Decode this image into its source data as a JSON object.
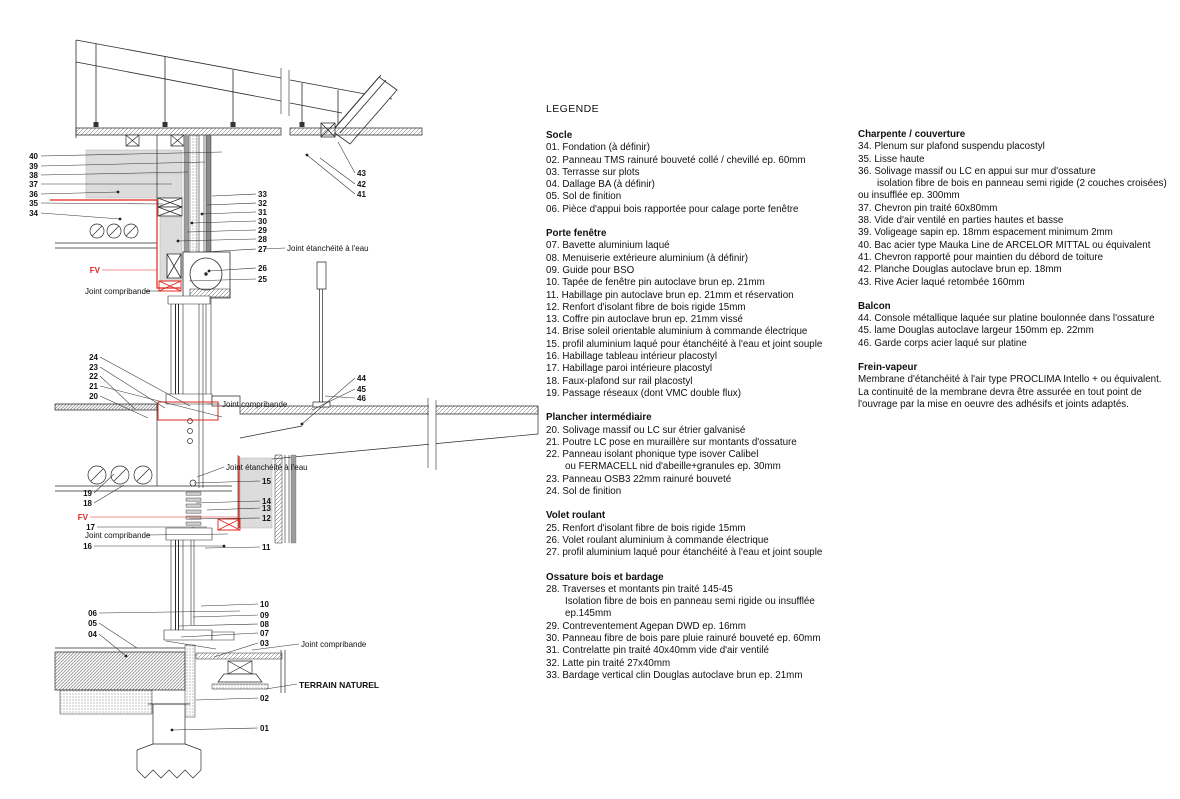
{
  "legend": {
    "title": "LEGENDE",
    "col1": [
      {
        "h": "Socle",
        "items": [
          {
            "n": "01.",
            "t": "Fondation (à définir)"
          },
          {
            "n": "02.",
            "t": "Panneau TMS rainuré bouveté collé / chevillé ep. 60mm"
          },
          {
            "n": "03.",
            "t": "Terrasse sur plots"
          },
          {
            "n": "04.",
            "t": "Dallage BA (à définir)"
          },
          {
            "n": "05.",
            "t": "Sol de finition"
          },
          {
            "n": "06.",
            "t": "Pièce d'appui bois rapportée pour calage porte fenêtre"
          }
        ]
      },
      {
        "h": "Porte fenêtre",
        "items": [
          {
            "n": "07.",
            "t": "Bavette aluminium laqué"
          },
          {
            "n": "08.",
            "t": "Menuiserie extérieure aluminium (à définir)"
          },
          {
            "n": "09.",
            "t": "Guide pour BSO"
          },
          {
            "n": "10.",
            "t": "Tapée de fenêtre pin autoclave brun ep. 21mm"
          },
          {
            "n": "11.",
            "t": "Habillage pin autoclave brun ep. 21mm et réservation"
          },
          {
            "n": "12.",
            "t": "Renfort d'isolant fibre de bois rigide 15mm"
          },
          {
            "n": "13.",
            "t": "Coffre pin autoclave brun ep. 21mm vissé"
          },
          {
            "n": "14.",
            "t": "Brise soleil orientable aluminium à commande électrique"
          },
          {
            "n": "15.",
            "t": "profil aluminium laqué pour étanchéité à l'eau et joint souple"
          },
          {
            "n": "16.",
            "t": "Habillage tableau intérieur placostyl"
          },
          {
            "n": "17.",
            "t": "Habillage paroi intérieure placostyl"
          },
          {
            "n": "18.",
            "t": "Faux-plafond sur rail placostyl"
          },
          {
            "n": "19.",
            "t": "Passage réseaux (dont VMC double flux)"
          }
        ]
      },
      {
        "h": "Plancher intermédiaire",
        "items": [
          {
            "n": "20.",
            "t": "Solivage massif ou LC sur étrier galvanisé"
          },
          {
            "n": "21.",
            "t": "Poutre LC pose en muraillère sur montants d'ossature"
          },
          {
            "n": "22.",
            "t": "Panneau isolant phonique type isover Calibel",
            "sub": [
              {
                "t": "ou FERMACELL nid d'abeille+granules ep. 30mm",
                "i": 1
              }
            ]
          },
          {
            "n": "23.",
            "t": "Panneau OSB3 22mm rainuré bouveté"
          },
          {
            "n": "24.",
            "t": "Sol de finition"
          }
        ]
      },
      {
        "h": "Volet roulant",
        "items": [
          {
            "n": "25.",
            "t": "Renfort d'isolant fibre de bois rigide 15mm"
          },
          {
            "n": "26.",
            "t": "Volet roulant aluminium à commande électrique"
          },
          {
            "n": "27.",
            "t": "profil aluminium laqué pour étanchéité à l'eau et joint souple"
          }
        ]
      },
      {
        "h": "Ossature bois et bardage",
        "items": [
          {
            "n": "28.",
            "t": "Traverses et montants pin traité 145-45",
            "sub": [
              {
                "t": "Isolation fibre de bois en panneau semi rigide ou insufflée ep.145mm",
                "i": 1
              }
            ]
          },
          {
            "n": "29.",
            "t": "Contreventement Agepan DWD ep. 16mm"
          },
          {
            "n": "30.",
            "t": "Panneau fibre de bois pare pluie rainuré bouveté ep. 60mm"
          },
          {
            "n": "31.",
            "t": "Contrelatte pin traité 40x40mm vide d'air ventilé"
          },
          {
            "n": "32.",
            "t": "Latte pin traité 27x40mm"
          },
          {
            "n": "33.",
            "t": "Bardage vertical clin Douglas autoclave brun ep. 21mm"
          }
        ]
      }
    ],
    "col2": [
      {
        "h": "Charpente / couverture",
        "items": [
          {
            "n": "34.",
            "t": "Plenum sur plafond suspendu placostyl"
          },
          {
            "n": "35.",
            "t": "Lisse haute"
          },
          {
            "n": "36.",
            "t": "Solivage massif ou LC en appui sur mur d'ossature",
            "sub": [
              {
                "t": "isolation fibre de bois en panneau semi rigide (2 couches croisées)",
                "i": 1
              },
              {
                "t": "ou insufflée ep. 300mm",
                "i": 0
              }
            ]
          },
          {
            "n": "37.",
            "t": "Chevron pin traité 60x80mm"
          },
          {
            "n": "38.",
            "t": "Vide d'air ventilé en parties hautes et basse"
          },
          {
            "n": "39.",
            "t": "Voligeage sapin ep. 18mm espacement minimum 2mm"
          },
          {
            "n": "40.",
            "t": "Bac acier type Mauka Line de ARCELOR MITTAL ou équivalent"
          },
          {
            "n": "41.",
            "t": "Chevron rapporté pour maintien du débord de toiture"
          },
          {
            "n": "42.",
            "t": "Planche Douglas autoclave brun ep. 18mm"
          },
          {
            "n": "43.",
            "t": "Rive Acier laqué retombée 160mm"
          }
        ]
      },
      {
        "h": "Balcon",
        "items": [
          {
            "n": "44.",
            "t": "Console métallique laquée sur platine boulonnée dans l'ossature"
          },
          {
            "n": "45.",
            "t": "lame Douglas autoclave largeur 150mm ep. 22mm"
          },
          {
            "n": "46.",
            "t": "Garde corps acier laqué sur platine"
          }
        ]
      },
      {
        "h": "Frein-vapeur",
        "para": [
          "Membrane d'étanchéité à l'air type PROCLIMA Intello + ou équivalent.",
          "La continuité de la membrane devra être assurée en tout point de",
          "l'ouvrage par la mise en oeuvre des adhésifs et joints adaptés."
        ]
      }
    ]
  },
  "drawing": {
    "colors": {
      "membrane": "#e0261c",
      "insulation": "#dcdcdc",
      "panel": "#9c9c9c",
      "line": "#2a2a2a"
    },
    "callouts": [
      {
        "t": "40",
        "x": 38,
        "y": 159,
        "a": "e",
        "l": [
          41,
          156,
          222,
          152
        ]
      },
      {
        "t": "39",
        "x": 38,
        "y": 169,
        "a": "e",
        "l": [
          41,
          166,
          205,
          162
        ]
      },
      {
        "t": "38",
        "x": 38,
        "y": 178,
        "a": "e",
        "l": [
          41,
          175,
          188,
          172
        ]
      },
      {
        "t": "37",
        "x": 38,
        "y": 187,
        "a": "e",
        "l": [
          41,
          184,
          172,
          184
        ]
      },
      {
        "t": "36",
        "x": 38,
        "y": 197,
        "a": "e",
        "l": [
          41,
          194,
          118,
          192
        ],
        "d": 1
      },
      {
        "t": "35",
        "x": 38,
        "y": 206,
        "a": "e",
        "l": [
          41,
          203,
          163,
          204
        ]
      },
      {
        "t": "34",
        "x": 38,
        "y": 216,
        "a": "e",
        "l": [
          41,
          213,
          120,
          219
        ],
        "d": 1
      },
      {
        "t": "43",
        "x": 357,
        "y": 176,
        "a": "s",
        "l": [
          355,
          173,
          338,
          142
        ]
      },
      {
        "t": "42",
        "x": 357,
        "y": 187,
        "a": "s",
        "l": [
          355,
          184,
          320,
          158
        ]
      },
      {
        "t": "41",
        "x": 357,
        "y": 197,
        "a": "s",
        "l": [
          355,
          194,
          307,
          155
        ],
        "d": 1
      },
      {
        "t": "33",
        "x": 258,
        "y": 197,
        "a": "s",
        "l": [
          256,
          194,
          212,
          196
        ]
      },
      {
        "t": "32",
        "x": 258,
        "y": 206,
        "a": "s",
        "l": [
          256,
          203,
          207,
          205
        ]
      },
      {
        "t": "31",
        "x": 258,
        "y": 215,
        "a": "s",
        "l": [
          256,
          212,
          202,
          214
        ],
        "d": 1
      },
      {
        "t": "30",
        "x": 258,
        "y": 224,
        "a": "s",
        "l": [
          256,
          221,
          192,
          223
        ],
        "d": 1
      },
      {
        "t": "29",
        "x": 258,
        "y": 233,
        "a": "s",
        "l": [
          256,
          230,
          187,
          232
        ]
      },
      {
        "t": "28",
        "x": 258,
        "y": 242,
        "a": "s",
        "l": [
          256,
          239,
          178,
          241
        ],
        "d": 1
      },
      {
        "t": "27",
        "x": 258,
        "y": 252,
        "a": "s",
        "l": [
          256,
          249,
          203,
          252
        ]
      },
      {
        "t": "Joint étanchéité à l'eau",
        "x": 287,
        "y": 251,
        "a": "s",
        "s": "l",
        "l": [
          285,
          248,
          264,
          249
        ]
      },
      {
        "t": "26",
        "x": 258,
        "y": 271,
        "a": "s",
        "l": [
          256,
          268,
          209,
          271
        ],
        "d": 1
      },
      {
        "t": "25",
        "x": 258,
        "y": 282,
        "a": "s",
        "l": [
          256,
          279,
          189,
          281
        ]
      },
      {
        "t": "FV",
        "x": 100,
        "y": 273,
        "a": "e",
        "s": "r",
        "l": [
          102,
          270,
          157,
          270
        ]
      },
      {
        "t": "Joint compribande",
        "x": 85,
        "y": 294,
        "a": "s",
        "s": "l",
        "l": [
          145,
          291,
          161,
          291
        ]
      },
      {
        "t": "24",
        "x": 98,
        "y": 360,
        "a": "e",
        "l": [
          100,
          357,
          190,
          406
        ]
      },
      {
        "t": "23",
        "x": 98,
        "y": 370,
        "a": "e",
        "l": [
          100,
          367,
          165,
          408
        ]
      },
      {
        "t": "22",
        "x": 98,
        "y": 379,
        "a": "e",
        "l": [
          100,
          376,
          135,
          409
        ]
      },
      {
        "t": "21",
        "x": 98,
        "y": 389,
        "a": "e",
        "l": [
          100,
          386,
          222,
          417
        ]
      },
      {
        "t": "20",
        "x": 98,
        "y": 399,
        "a": "e",
        "l": [
          100,
          396,
          148,
          418
        ]
      },
      {
        "t": "Joint compribande",
        "x": 222,
        "y": 407,
        "a": "s",
        "s": "l",
        "l": [
          220,
          404,
          207,
          404
        ]
      },
      {
        "t": "44",
        "x": 357,
        "y": 381,
        "a": "s",
        "l": [
          355,
          378,
          302,
          424
        ],
        "d": 1
      },
      {
        "t": "45",
        "x": 357,
        "y": 392,
        "a": "s",
        "l": [
          355,
          389,
          312,
          410
        ]
      },
      {
        "t": "46",
        "x": 357,
        "y": 401,
        "a": "s",
        "l": [
          355,
          398,
          325,
          396
        ]
      },
      {
        "t": "Joint étanchéité à l'eau",
        "x": 226,
        "y": 470,
        "a": "s",
        "s": "l",
        "l": [
          224,
          467,
          197,
          477
        ]
      },
      {
        "t": "15",
        "x": 262,
        "y": 484,
        "a": "s",
        "l": [
          260,
          481,
          194,
          483
        ]
      },
      {
        "t": "14",
        "x": 262,
        "y": 504,
        "a": "s",
        "l": [
          260,
          501,
          196,
          503
        ]
      },
      {
        "t": "13",
        "x": 262,
        "y": 511,
        "a": "s",
        "l": [
          260,
          508,
          207,
          510
        ]
      },
      {
        "t": "12",
        "x": 262,
        "y": 521,
        "a": "s",
        "l": [
          260,
          518,
          189,
          519
        ]
      },
      {
        "t": "11",
        "x": 262,
        "y": 550,
        "a": "s",
        "l": [
          260,
          547,
          205,
          548
        ]
      },
      {
        "t": "19",
        "x": 92,
        "y": 496,
        "a": "e",
        "l": [
          94,
          493,
          114,
          474
        ]
      },
      {
        "t": "18",
        "x": 92,
        "y": 506,
        "a": "e",
        "l": [
          94,
          503,
          124,
          485
        ]
      },
      {
        "t": "FV",
        "x": 88,
        "y": 520,
        "a": "e",
        "s": "r",
        "l": [
          90,
          517,
          238,
          517
        ]
      },
      {
        "t": "17",
        "x": 95,
        "y": 530,
        "a": "e",
        "l": [
          97,
          527,
          207,
          527
        ]
      },
      {
        "t": "Joint compribande",
        "x": 85,
        "y": 538,
        "a": "s",
        "s": "l",
        "l": [
          147,
          535,
          228,
          534
        ]
      },
      {
        "t": "16",
        "x": 92,
        "y": 549,
        "a": "e",
        "l": [
          94,
          546,
          224,
          546
        ],
        "d": 1
      },
      {
        "t": "06",
        "x": 97,
        "y": 616,
        "a": "e",
        "l": [
          99,
          613,
          240,
          611
        ]
      },
      {
        "t": "05",
        "x": 97,
        "y": 626,
        "a": "e",
        "l": [
          99,
          623,
          137,
          648
        ]
      },
      {
        "t": "04",
        "x": 97,
        "y": 637,
        "a": "e",
        "l": [
          99,
          634,
          126,
          656
        ],
        "d": 1
      },
      {
        "t": "10",
        "x": 260,
        "y": 607,
        "a": "s",
        "l": [
          258,
          604,
          201,
          606
        ]
      },
      {
        "t": "09",
        "x": 260,
        "y": 618,
        "a": "s",
        "l": [
          258,
          615,
          193,
          617
        ]
      },
      {
        "t": "08",
        "x": 260,
        "y": 627,
        "a": "s",
        "l": [
          258,
          624,
          179,
          626
        ]
      },
      {
        "t": "07",
        "x": 260,
        "y": 636,
        "a": "s",
        "l": [
          258,
          633,
          181,
          637
        ]
      },
      {
        "t": "03",
        "x": 260,
        "y": 646,
        "a": "s",
        "l": [
          258,
          643,
          214,
          657
        ]
      },
      {
        "t": "Joint compribande",
        "x": 301,
        "y": 647,
        "a": "s",
        "s": "l",
        "l": [
          299,
          644,
          252,
          650
        ]
      },
      {
        "t": "TERRAIN NATUREL",
        "x": 299,
        "y": 688,
        "a": "s",
        "s": "t",
        "l": [
          297,
          684,
          266,
          689
        ]
      },
      {
        "t": "02",
        "x": 260,
        "y": 701,
        "a": "s",
        "l": [
          258,
          698,
          196,
          700
        ]
      },
      {
        "t": "01",
        "x": 260,
        "y": 731,
        "a": "s",
        "l": [
          258,
          728,
          172,
          730
        ],
        "d": 1
      }
    ]
  }
}
